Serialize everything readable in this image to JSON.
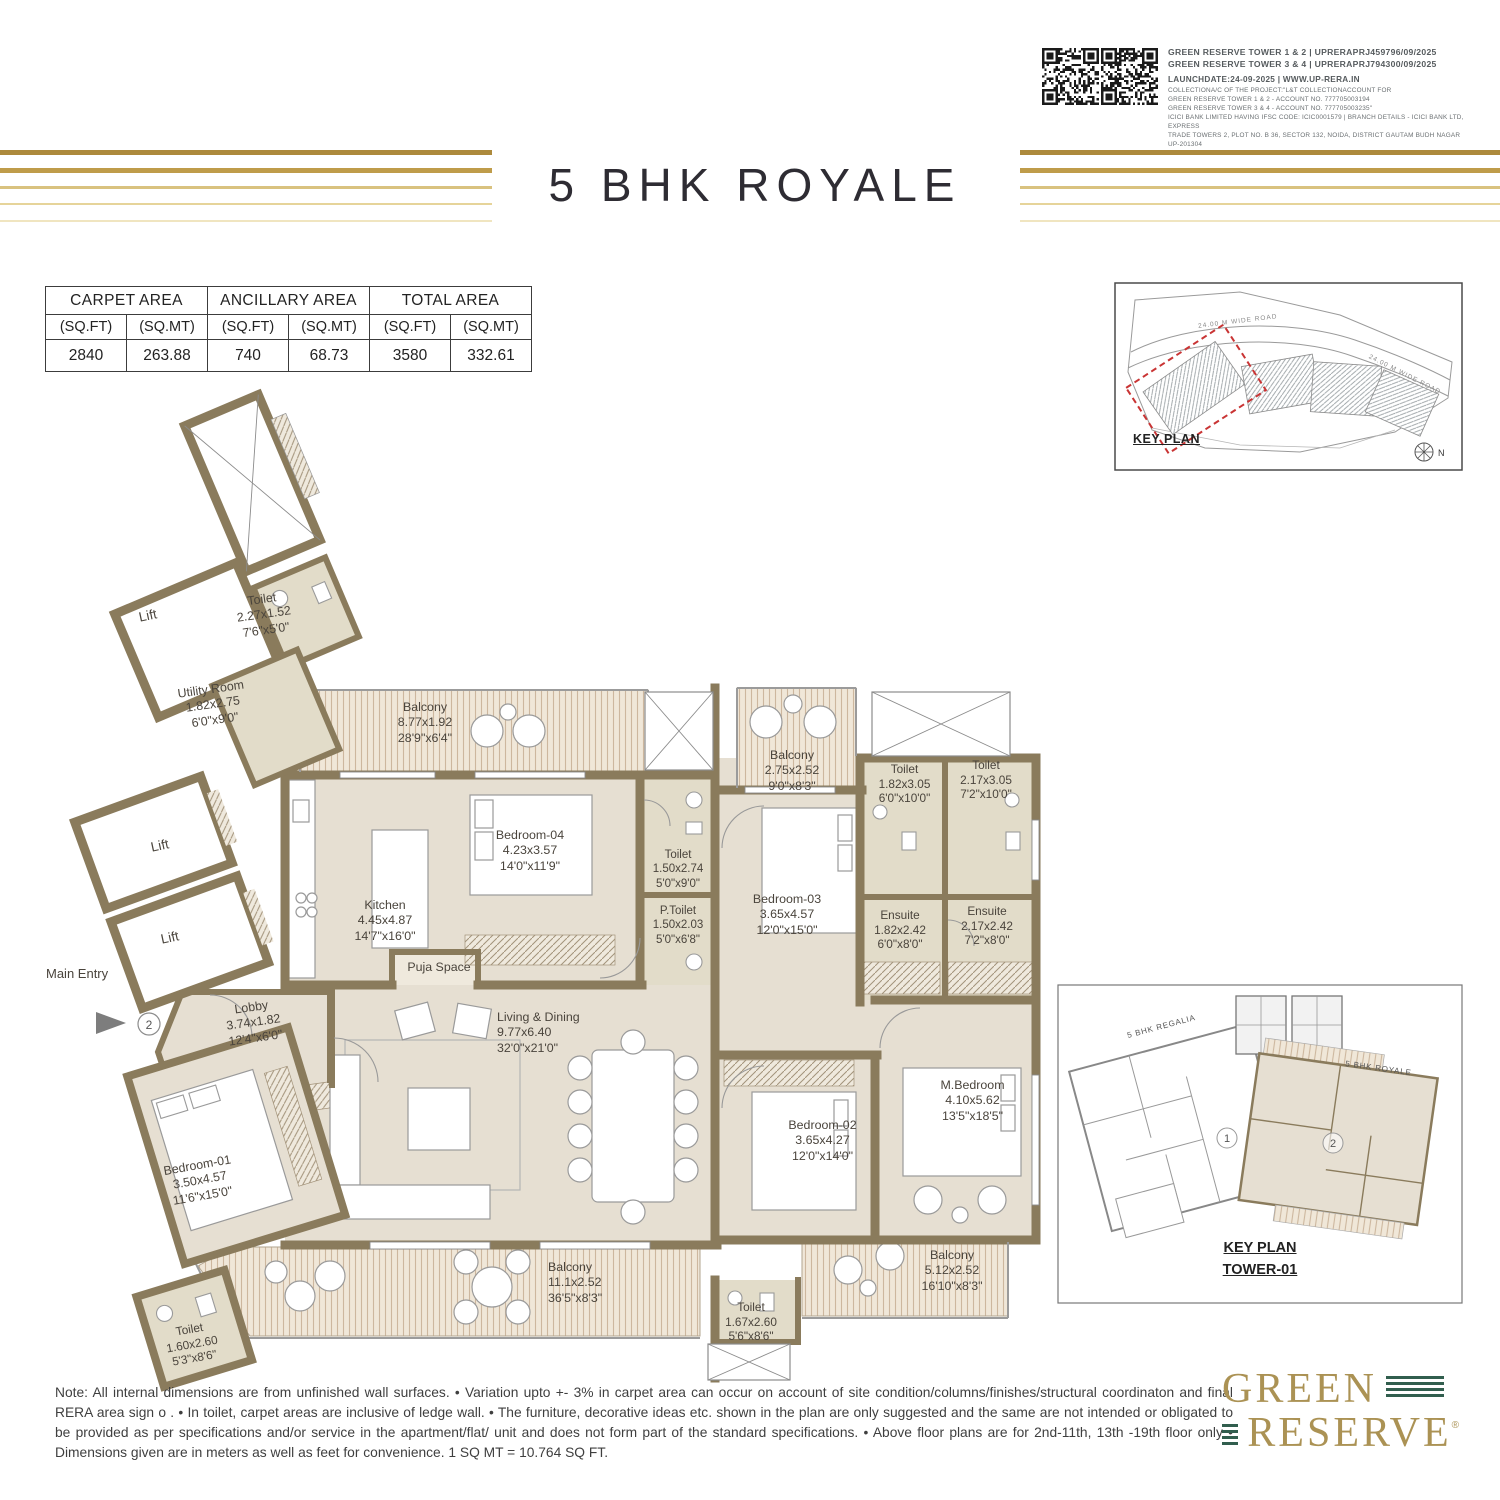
{
  "header": {
    "rera_line_1": "GREEN RESERVE TOWER 1 & 2 | UPRERAPRJ459796/09/2025",
    "rera_line_2": "GREEN RESERVE TOWER 3 & 4 | UPRERAPRJ794300/09/2025",
    "launch_line": "LAUNCHDATE:24-09-2025 | WWW.UP-RERA.IN",
    "legal_lines": [
      "COLLECTIONA/C OF THE PROJECT:\"L&T COLLECTIONACCOUNT FOR",
      "GREEN RESERVE TOWER 1 & 2 - ACCOUNT NO. 777705003194",
      "GREEN RESERVE TOWER 3 & 4 - ACCOUNT NO. 777705003235\"",
      "ICICI BANK LIMITED HAVING IFSC CODE: ICIC0001579 | BRANCH DETAILS - ICICI BANK LTD, EXPRESS",
      "TRADE TOWERS 2, PLOT NO. B 36, SECTOR 132, NOIDA, DISTRICT GAUTAM BUDH NAGAR UP-201304"
    ]
  },
  "title": "5 BHK ROYALE",
  "area_table": {
    "groups": [
      "CARPET AREA",
      "ANCILLARY AREA",
      "TOTAL AREA"
    ],
    "subheaders": [
      "(SQ.FT)",
      "(SQ.MT)",
      "(SQ.FT)",
      "(SQ.MT)",
      "(SQ.FT)",
      "(SQ.MT)"
    ],
    "values": [
      "2840",
      "263.88",
      "740",
      "68.73",
      "3580",
      "332.61"
    ]
  },
  "key_plan": {
    "label": "KEY PLAN",
    "road_label_1": "24.00 M WIDE ROAD",
    "road_label_2": "24.00 M WIDE ROAD",
    "compass": "N"
  },
  "plan": {
    "main_entry_label": "Main Entry",
    "entry_number": "2",
    "rooms": [
      {
        "name": "Toilet",
        "dim_m": "2.27x1.52",
        "dim_ft": "7'6\"x5'0\""
      },
      {
        "name": "Lift"
      },
      {
        "name": "Utility Room",
        "dim_m": "1.82x2.75",
        "dim_ft": "6'0\"x9'0\""
      },
      {
        "name": "Lift"
      },
      {
        "name": "Lift"
      },
      {
        "name": "Balcony",
        "dim_m": "8.77x1.92",
        "dim_ft": "28'9\"x6'4\""
      },
      {
        "name": "Kitchen",
        "dim_m": "4.45x4.87",
        "dim_ft": "14'7\"x16'0\""
      },
      {
        "name": "Bedroom-04",
        "dim_m": "4.23x3.57",
        "dim_ft": "14'0\"x11'9\""
      },
      {
        "name": "Toilet",
        "dim_m": "1.50x2.74",
        "dim_ft": "5'0\"x9'0\""
      },
      {
        "name": "P.Toilet",
        "dim_m": "1.50x2.03",
        "dim_ft": "5'0\"x6'8\""
      },
      {
        "name": "Balcony",
        "dim_m": "2.75x2.52",
        "dim_ft": "9'0\"x8'3\""
      },
      {
        "name": "Toilet",
        "dim_m": "1.82x3.05",
        "dim_ft": "6'0\"x10'0\""
      },
      {
        "name": "Toilet",
        "dim_m": "2.17x3.05",
        "dim_ft": "7'2\"x10'0\""
      },
      {
        "name": "Bedroom-03",
        "dim_m": "3.65x4.57",
        "dim_ft": "12'0\"x15'0\""
      },
      {
        "name": "Ensuite",
        "dim_m": "1.82x2.42",
        "dim_ft": "6'0\"x8'0\""
      },
      {
        "name": "Ensuite",
        "dim_m": "2.17x2.42",
        "dim_ft": "7'2\"x8'0\""
      },
      {
        "name": "Lobby",
        "dim_m": "3.74x1.82",
        "dim_ft": "12'4\"x6'0\""
      },
      {
        "name": "Puja Space"
      },
      {
        "name": "Living & Dining",
        "dim_m": "9.77x6.40",
        "dim_ft": "32'0\"x21'0\""
      },
      {
        "name": "Bedroom-01",
        "dim_m": "3.50x4.57",
        "dim_ft": "11'6\"x15'0\""
      },
      {
        "name": "Bedroom-02",
        "dim_m": "3.65x4.27",
        "dim_ft": "12'0\"x14'0\""
      },
      {
        "name": "M.Bedroom",
        "dim_m": "4.10x5.62",
        "dim_ft": "13'5\"x18'5\""
      },
      {
        "name": "Balcony",
        "dim_m": "11.1x2.52",
        "dim_ft": "36'5\"x8'3\""
      },
      {
        "name": "Toilet",
        "dim_m": "1.67x2.60",
        "dim_ft": "5'6\"x8'6\""
      },
      {
        "name": "Balcony",
        "dim_m": "5.12x2.52",
        "dim_ft": "16'10\"x8'3\""
      },
      {
        "name": "Toilet",
        "dim_m": "1.60x2.60",
        "dim_ft": "5'3\"x8'6\""
      }
    ]
  },
  "tower_key_plan": {
    "unit1_label": "5 BHK REGALIA",
    "unit2_label": "5 BHK ROYALE",
    "unit1_no": "1",
    "unit2_no": "2",
    "title_line1": "KEY PLAN",
    "title_line2": "TOWER-01"
  },
  "note": "Note: All internal dimensions are from unfinished wall surfaces. • Variation upto +- 3% in carpet area can occur on account of site condition/columns/finishes/structural coordinaton and final RERA area sign o . • In toilet, carpet areas are inclusive of ledge wall. • The furniture, decorative ideas etc. shown in the plan are only suggested and the same are not intended or obligated to be provided as per specifications and/or service in the apartment/flat/ unit and does not form part of the standard specifications. • Above floor plans are for 2nd-11th, 13th -19th floor only • Dimensions given are in meters as well as feet for convenience. 1 SQ MT = 10.764 SQ FT.",
  "logo": {
    "line1": "GREEN",
    "line2": "RESERVE",
    "reg": "®"
  },
  "colors": {
    "wall": "#8a7b5c",
    "floor": "#e6dfd2",
    "toilet_floor": "#e2dcc9",
    "deck_stripe": "#cdb79e",
    "gold_dark": "#ad8a3c",
    "gold_light": "#f0e5c0",
    "logo_gold": "#ab9254",
    "logo_green": "#315e4e",
    "keyplan_red": "#c93434"
  }
}
